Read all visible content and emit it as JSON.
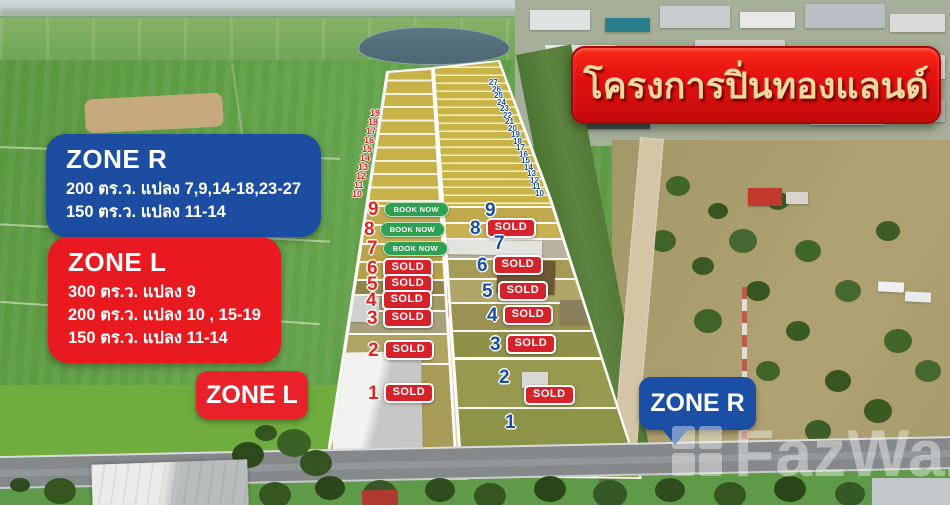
{
  "banner": {
    "title": "โครงการปิ่นทองแลนด์"
  },
  "info_boxes": {
    "zone_r": {
      "title": "ZONE R",
      "lines": [
        "200 ตร.ว. แปลง 7,9,14-18,23-27",
        "150 ตร.ว.  แปลง 11-14"
      ]
    },
    "zone_l": {
      "title": "ZONE L",
      "lines": [
        "300 ตร.ว. แปลง 9",
        "200 ตร.ว. แปลง 10 , 15-19",
        "150 ตร.ว.  แปลง 11-14"
      ]
    }
  },
  "zone_markers": {
    "left": "ZONE L",
    "right": "ZONE R"
  },
  "plots": {
    "left": {
      "strips": [
        "19",
        "18",
        "17",
        "16",
        "15",
        "14",
        "13",
        "12",
        "11",
        "10"
      ],
      "rows": [
        {
          "num": "9",
          "badge": "BOOK NOW"
        },
        {
          "num": "8",
          "badge": "BOOK NOW"
        },
        {
          "num": "7",
          "badge": "BOOK NOW"
        },
        {
          "num": "6",
          "badge": "SOLD"
        },
        {
          "num": "5",
          "badge": "SOLD"
        },
        {
          "num": "4",
          "badge": "SOLD"
        },
        {
          "num": "3",
          "badge": "SOLD"
        },
        {
          "num": "2",
          "badge": "SOLD"
        },
        {
          "num": "1",
          "badge": "SOLD"
        }
      ]
    },
    "right": {
      "strips": [
        "27",
        "26",
        "25",
        "24",
        "23",
        "22",
        "21",
        "20",
        "19",
        "18",
        "17",
        "16",
        "15",
        "14",
        "13",
        "12",
        "11",
        "10"
      ],
      "rows": [
        {
          "num": "9",
          "badge": ""
        },
        {
          "num": "8",
          "badge": "SOLD"
        },
        {
          "num": "7",
          "badge": ""
        },
        {
          "num": "6",
          "badge": "SOLD"
        },
        {
          "num": "5",
          "badge": "SOLD"
        },
        {
          "num": "4",
          "badge": "SOLD"
        },
        {
          "num": "3",
          "badge": "SOLD"
        },
        {
          "num": "2",
          "badge": "SOLD"
        },
        {
          "num": "1",
          "badge": ""
        }
      ]
    }
  },
  "watermark": {
    "text": "FazWaz"
  },
  "colors": {
    "accent_red": "#e8191f",
    "accent_blue": "#1c4da1",
    "sold_red": "#d6232b",
    "book_green": "#2fa052",
    "banner_red": "#e31111",
    "banner_text": "#eeda9f"
  }
}
